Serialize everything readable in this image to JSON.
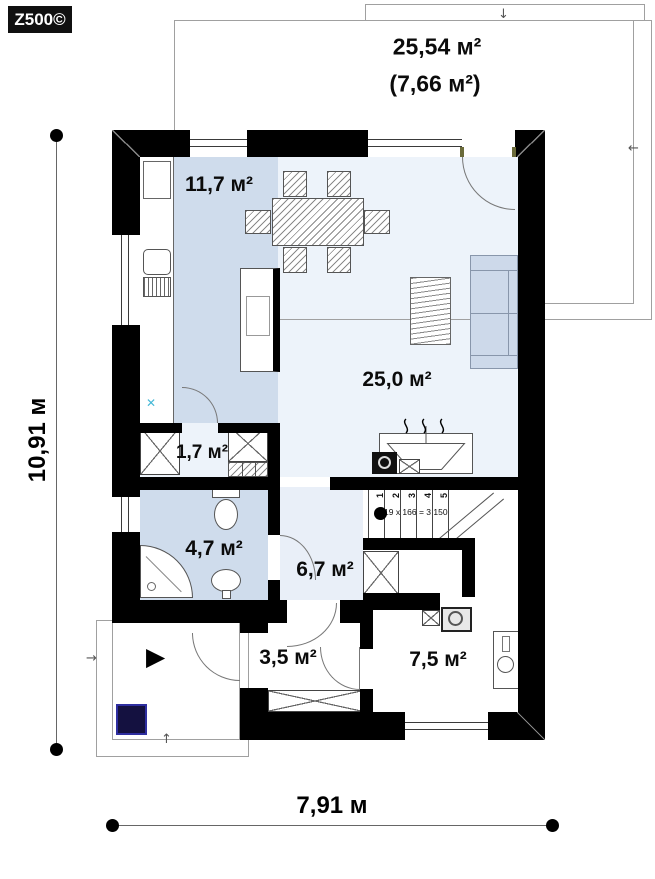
{
  "logo": "Z500©",
  "terrace": {
    "area_main": "25,54 м²",
    "area_alt": "(7,66 м²)"
  },
  "areas": {
    "kitchen": "11,7 м²",
    "living": "25,0 м²",
    "wardrobe": "1,7 м²",
    "bathroom": "4,7 м²",
    "hall": "6,7 м²",
    "vestibule": "3,5 м²",
    "utility": "7,5 м²"
  },
  "stairs": {
    "steps": [
      "1",
      "2",
      "3",
      "4",
      "5"
    ],
    "formula": "19 x 166 = 3 150"
  },
  "dimensions": {
    "height": "10,91 м",
    "width": "7,91 м"
  },
  "icons": {
    "entrance": "▶",
    "arrow_down": "↓",
    "arrow_left": "←",
    "arrow_right": "→",
    "arrow_up": "↑",
    "water_point": "✕"
  },
  "colors": {
    "wall": "#000000",
    "kitchen_floor": "#cfdcec",
    "living_floor": "#edf3fa",
    "hall_floor": "#e9eff8",
    "sofa": "#cdd9ea",
    "porch_square": "#141140",
    "water_mark": "#45b8d6",
    "window_tick": "#6b6b3a"
  }
}
